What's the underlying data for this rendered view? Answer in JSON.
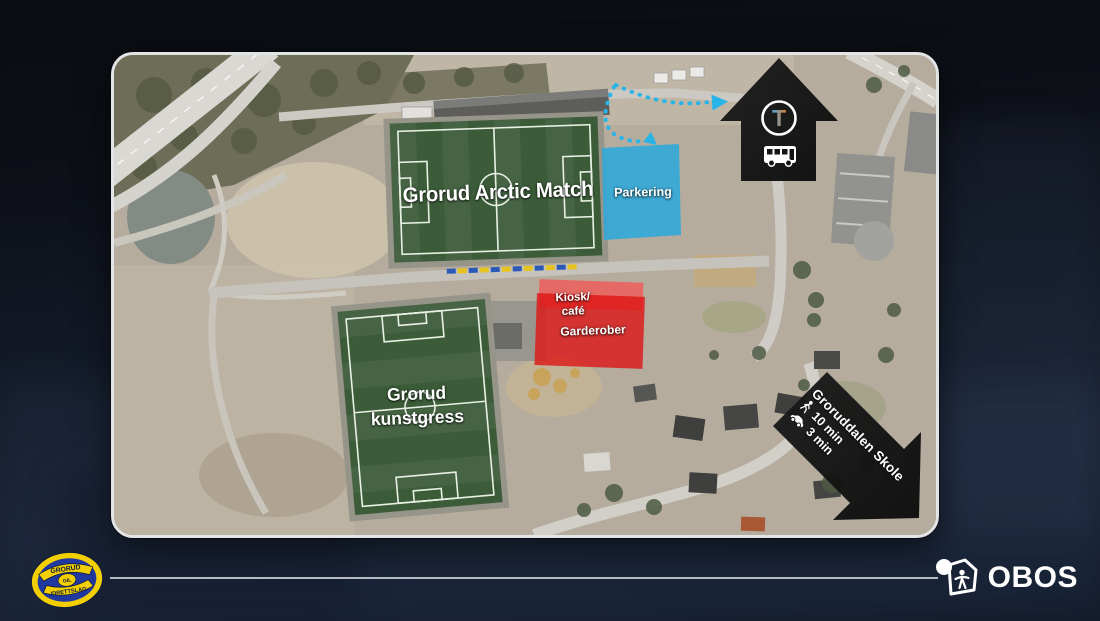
{
  "map": {
    "pitch_main": {
      "label": "Grorud Arctic Match"
    },
    "pitch_secondary": {
      "label_line1": "Grorud",
      "label_line2": "kunstgress"
    },
    "parking": {
      "label": "Parkering",
      "color": "#2aa9dd"
    },
    "facilities": {
      "kiosk_line1": "Kiosk/",
      "kiosk_line2": "café",
      "locker_label": "Garderober",
      "color": "#dd1c1c"
    },
    "transit_arrow": {
      "metro_symbol": "T",
      "icons": [
        "metro-t-icon",
        "bus-icon"
      ],
      "color": "#161616"
    },
    "school_arrow": {
      "title": "Groruddalen Skole",
      "walk_time": "10 min",
      "drive_time": "3 min",
      "icons": [
        "walking-icon",
        "car-icon"
      ],
      "color": "#161616"
    },
    "route_color": "#27b4e8"
  },
  "footer": {
    "club_logo": {
      "top_text": "GRORUD",
      "center_text": "GIL",
      "bottom_text": "IDRETTSLAG",
      "yellow": "#f2cf00",
      "blue": "#2038a0"
    },
    "obos": {
      "label": "OBOS"
    }
  }
}
